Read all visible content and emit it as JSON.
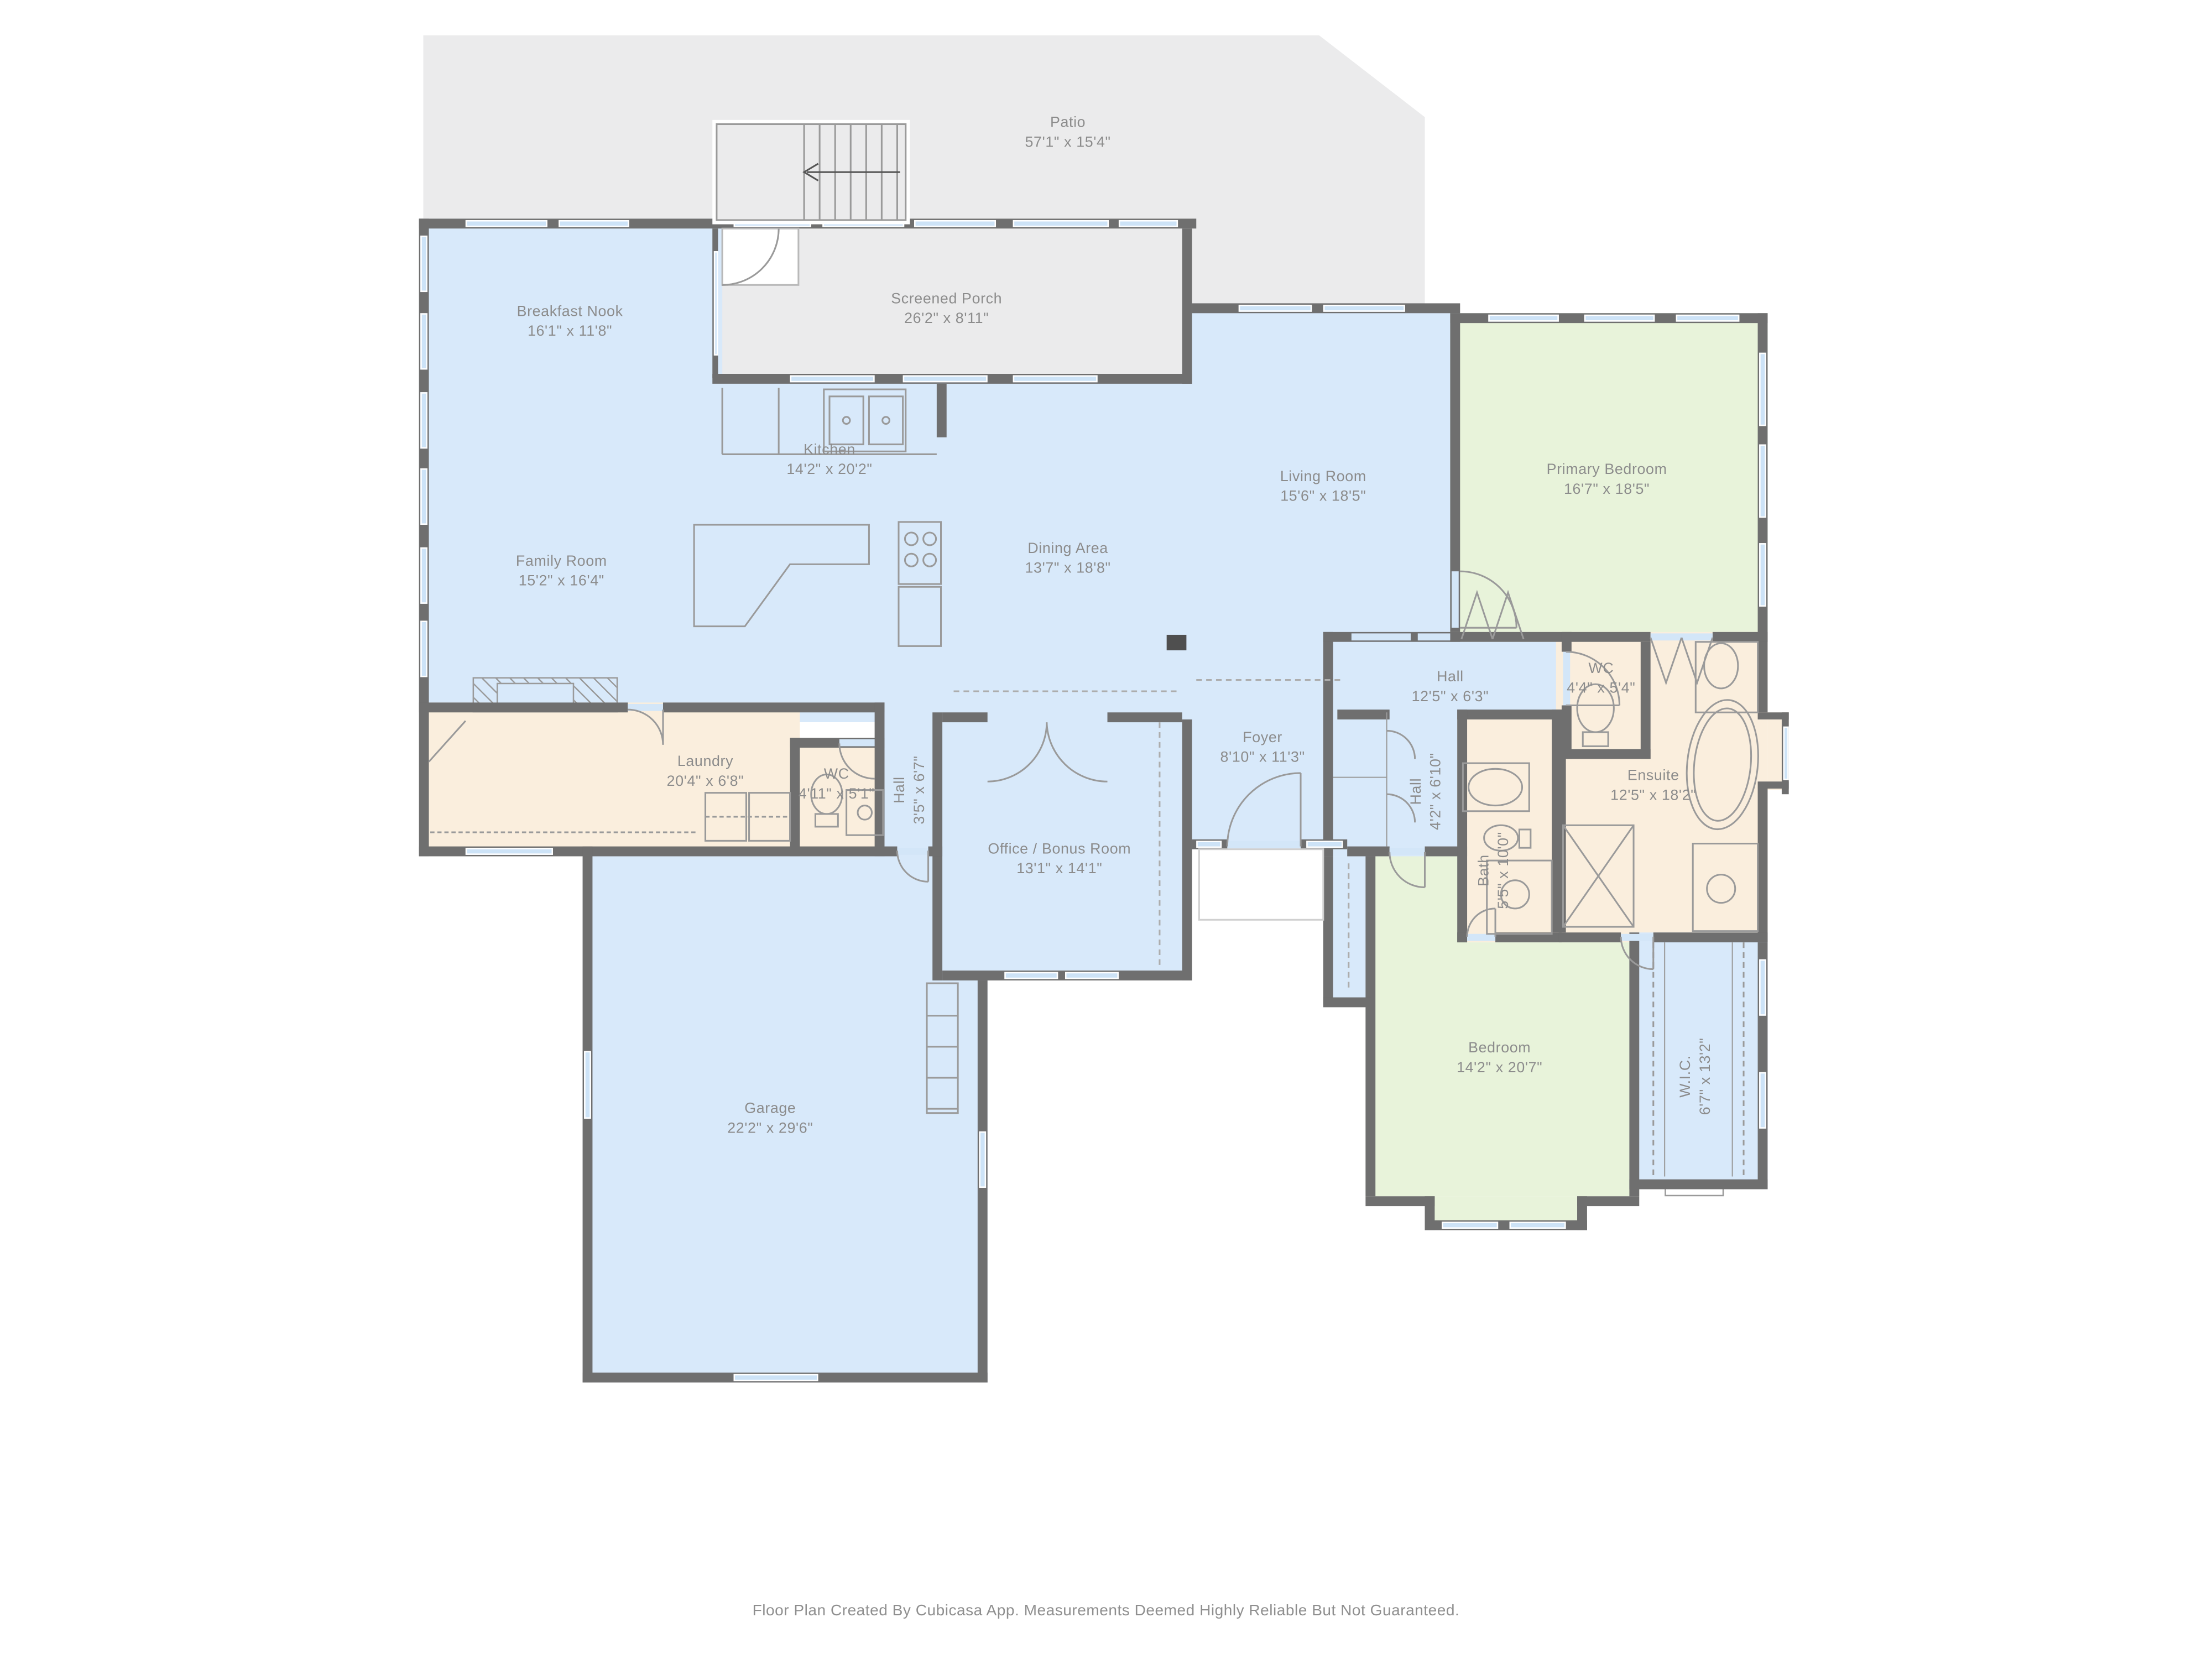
{
  "title": "Floor Plan",
  "footer": "Floor Plan Created By Cubicasa App. Measurements Deemed Highly Reliable But Not Guaranteed.",
  "colors": {
    "room_blue": "#d8e9fa",
    "room_green": "#e8f3da",
    "room_beige": "#faeedd",
    "room_gray": "#ebebec",
    "wall": "#6f6f6f",
    "window": "#cde3f7",
    "label_text": "#8c8c8c"
  },
  "rooms": [
    {
      "name": "Patio",
      "dims": "57'1\" x 15'4\""
    },
    {
      "name": "Screened Porch",
      "dims": "26'2\" x 8'11\""
    },
    {
      "name": "Breakfast Nook",
      "dims": "16'1\" x 11'8\""
    },
    {
      "name": "Family Room",
      "dims": "15'2\" x 16'4\""
    },
    {
      "name": "Kitchen",
      "dims": "14'2\" x 20'2\""
    },
    {
      "name": "Dining Area",
      "dims": "13'7\" x 18'8\""
    },
    {
      "name": "Living Room",
      "dims": "15'6\" x 18'5\""
    },
    {
      "name": "Primary Bedroom",
      "dims": "16'7\" x 18'5\""
    },
    {
      "name": "Hall",
      "dims": "12'5\" x 6'3\""
    },
    {
      "name": "WC",
      "dims": "4'4\" x 5'4\""
    },
    {
      "name": "Ensuite",
      "dims": "12'5\" x 18'2\""
    },
    {
      "name": "Foyer",
      "dims": "8'10\" x 11'3\""
    },
    {
      "name": "Laundry",
      "dims": "20'4\" x 6'8\""
    },
    {
      "name": "WC",
      "dims": "4'11\" x 5'1\""
    },
    {
      "name": "Hall",
      "dims": "3'5\" x 6'7\""
    },
    {
      "name": "Hall",
      "dims": "4'2\" x 6'10\""
    },
    {
      "name": "Bath",
      "dims": "5'5\" x 10'0\""
    },
    {
      "name": "Office / Bonus Room",
      "dims": "13'1\" x 14'1\""
    },
    {
      "name": "Garage",
      "dims": "22'2\" x 29'6\""
    },
    {
      "name": "Bedroom",
      "dims": "14'2\" x 20'7\""
    },
    {
      "name": "W.I.C.",
      "dims": "6'7\" x 13'2\""
    }
  ]
}
